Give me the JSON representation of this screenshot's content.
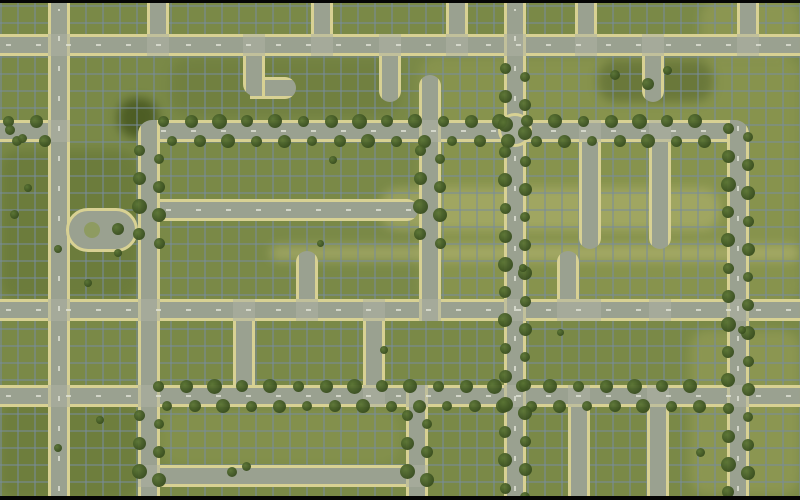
{
  "app": {
    "view": "city-builder-aerial-map",
    "visible_text": "none"
  },
  "scene": {
    "width": 800,
    "height": 500,
    "road_thickness": 22,
    "colors": {
      "grass": "#7a8947",
      "road_fill": "#9aa190",
      "road_edge": "#d8d193",
      "grid_line": "#788c9e",
      "tree_dark": "#394e1f",
      "tree_light": "#5a7434",
      "intersection": "#aeb3a3",
      "letterbox": "#050505",
      "lane_dash": "#e4e6da"
    },
    "letterbox": {
      "top": 3,
      "bottom": 4
    },
    "patches": [
      {
        "x": 420,
        "y": 56,
        "w": 380,
        "h": 250,
        "color": "#a3a85c",
        "op": 0.32
      },
      {
        "x": 380,
        "y": 188,
        "w": 340,
        "h": 42,
        "color": "#c9c583",
        "op": 0.38
      },
      {
        "x": 270,
        "y": 245,
        "w": 530,
        "h": 16,
        "color": "#c9c583",
        "op": 0.42
      },
      {
        "x": 118,
        "y": 98,
        "w": 40,
        "h": 40,
        "color": "#46561f",
        "op": 0.85
      },
      {
        "x": 0,
        "y": 150,
        "w": 140,
        "h": 150,
        "color": "#5d6e2f",
        "op": 0.45
      },
      {
        "x": 170,
        "y": 58,
        "w": 230,
        "h": 58,
        "color": "#687739",
        "op": 0.45
      },
      {
        "x": 598,
        "y": 60,
        "w": 115,
        "h": 42,
        "color": "#4e5e28",
        "op": 0.5
      },
      {
        "x": 690,
        "y": 330,
        "w": 110,
        "h": 165,
        "color": "#a8ab63",
        "op": 0.38
      },
      {
        "x": 700,
        "y": 0,
        "w": 100,
        "h": 56,
        "color": "#a8ab63",
        "op": 0.38
      },
      {
        "x": 0,
        "y": 400,
        "w": 140,
        "h": 100,
        "color": "#5d6e2f",
        "op": 0.4
      },
      {
        "x": 160,
        "y": 410,
        "w": 240,
        "h": 55,
        "color": "#97a057",
        "op": 0.32
      }
    ],
    "roads": [
      {
        "id": "top-avenue",
        "o": "h",
        "x": 0,
        "y": 34,
        "len": 800,
        "dashes": true
      },
      {
        "id": "tree-ave-west-stub",
        "o": "h",
        "x": 0,
        "y": 120,
        "len": 60,
        "trees": true
      },
      {
        "id": "tree-avenue",
        "o": "h",
        "x": 155,
        "y": 120,
        "len": 572,
        "trees": true,
        "dashes": true
      },
      {
        "id": "mid-deadend-road",
        "o": "h",
        "x": 160,
        "y": 199,
        "len": 258,
        "cap": "right",
        "dashes": true
      },
      {
        "id": "central-avenue",
        "o": "h",
        "x": 0,
        "y": 299,
        "len": 800,
        "dashes": true
      },
      {
        "id": "lower-tree-avenue",
        "o": "h",
        "x": 0,
        "y": 385,
        "len": 800,
        "dashes": true,
        "trees": true,
        "treeRange": [
          150,
          720
        ]
      },
      {
        "id": "bottom-street",
        "o": "h",
        "x": 155,
        "y": 465,
        "len": 273
      },
      {
        "id": "hook-stub-east",
        "o": "h",
        "x": 250,
        "y": 77,
        "len": 46,
        "cap": "right"
      },
      {
        "id": "west-vertical",
        "o": "v",
        "x": 48,
        "y": 3,
        "len": 494,
        "dashes": true
      },
      {
        "id": "v-top-a",
        "o": "v",
        "x": 147,
        "y": 3,
        "len": 31
      },
      {
        "id": "west-tree-vertical",
        "o": "v",
        "x": 138,
        "y": 120,
        "len": 377,
        "round": "14px 0 0 0",
        "trees": true,
        "treeRanges": [
          [
            142,
            258
          ],
          [
            407,
            494
          ]
        ]
      },
      {
        "id": "hook-vertical",
        "o": "v",
        "x": 243,
        "y": 56,
        "len": 40,
        "round": "0 0 0 12px"
      },
      {
        "id": "v-top-b",
        "o": "v",
        "x": 311,
        "y": 3,
        "len": 31
      },
      {
        "id": "v-top-c",
        "o": "v",
        "x": 446,
        "y": 3,
        "len": 31
      },
      {
        "id": "v-top-d",
        "o": "v",
        "x": 575,
        "y": 3,
        "len": 31
      },
      {
        "id": "v-top-e",
        "o": "v",
        "x": 737,
        "y": 3,
        "len": 31
      },
      {
        "id": "stub-from-top-a",
        "o": "v",
        "x": 379,
        "y": 56,
        "len": 46,
        "cap": "bottom"
      },
      {
        "id": "stub-from-top-b",
        "o": "v",
        "x": 642,
        "y": 56,
        "len": 46,
        "cap": "bottom"
      },
      {
        "id": "stub-up-center",
        "o": "v",
        "x": 419,
        "y": 75,
        "len": 45,
        "cap": "top"
      },
      {
        "id": "center-tree-vertical",
        "o": "v",
        "x": 419,
        "y": 120,
        "len": 201,
        "trees": true,
        "treeRanges": [
          [
            142,
            255
          ]
        ]
      },
      {
        "id": "main-tree-vertical",
        "o": "v",
        "x": 504,
        "y": 3,
        "len": 494,
        "trees": true,
        "treeRanges": [
          [
            60,
            494
          ]
        ],
        "dashes": true
      },
      {
        "id": "stub-down-mid-a",
        "o": "v",
        "x": 579,
        "y": 142,
        "len": 107,
        "cap": "bottom"
      },
      {
        "id": "stub-down-mid-b",
        "o": "v",
        "x": 649,
        "y": 142,
        "len": 107,
        "cap": "bottom"
      },
      {
        "id": "stub-up-central-a",
        "o": "v",
        "x": 296,
        "y": 251,
        "len": 48,
        "cap": "top"
      },
      {
        "id": "stub-up-central-b",
        "o": "v",
        "x": 557,
        "y": 251,
        "len": 48,
        "cap": "top"
      },
      {
        "id": "connector-a",
        "o": "v",
        "x": 233,
        "y": 321,
        "len": 64
      },
      {
        "id": "connector-b",
        "o": "v",
        "x": 363,
        "y": 321,
        "len": 64
      },
      {
        "id": "south-tree-vertical",
        "o": "v",
        "x": 406,
        "y": 385,
        "len": 112,
        "trees": true,
        "treeRanges": [
          [
            407,
            494
          ]
        ]
      },
      {
        "id": "south-street-a",
        "o": "v",
        "x": 568,
        "y": 407,
        "len": 90
      },
      {
        "id": "south-street-b",
        "o": "v",
        "x": 647,
        "y": 407,
        "len": 90
      },
      {
        "id": "east-tree-vertical",
        "o": "v",
        "x": 727,
        "y": 120,
        "len": 377,
        "round": "0 14px 0 0",
        "trees": true,
        "dashes": true
      }
    ],
    "cul_de_sac": {
      "x": 66,
      "y": 208,
      "w": 72,
      "h": 44,
      "tree": [
        118,
        229,
        12
      ]
    },
    "roundabout": {
      "x": 498,
      "y": 113,
      "w": 34,
      "h": 34
    },
    "intersections": [
      [
        48,
        34
      ],
      [
        147,
        34
      ],
      [
        243,
        34
      ],
      [
        311,
        34
      ],
      [
        379,
        34
      ],
      [
        446,
        34
      ],
      [
        504,
        34
      ],
      [
        575,
        34
      ],
      [
        642,
        34
      ],
      [
        737,
        34
      ],
      [
        48,
        120
      ],
      [
        419,
        120
      ],
      [
        579,
        120
      ],
      [
        649,
        120
      ],
      [
        48,
        299
      ],
      [
        138,
        299
      ],
      [
        233,
        299
      ],
      [
        296,
        299
      ],
      [
        363,
        299
      ],
      [
        419,
        299
      ],
      [
        504,
        299
      ],
      [
        557,
        299
      ],
      [
        579,
        299
      ],
      [
        649,
        299
      ],
      [
        727,
        299
      ],
      [
        48,
        385
      ],
      [
        138,
        385
      ],
      [
        363,
        385
      ],
      [
        406,
        385
      ],
      [
        504,
        385
      ],
      [
        568,
        385
      ],
      [
        647,
        385
      ],
      [
        727,
        385
      ],
      [
        138,
        465
      ],
      [
        406,
        465
      ]
    ],
    "scatter_trees": [
      [
        14,
        214,
        9
      ],
      [
        58,
        249,
        8
      ],
      [
        88,
        283,
        8
      ],
      [
        118,
        253,
        8
      ],
      [
        28,
        188,
        8
      ],
      [
        320,
        243,
        7
      ],
      [
        333,
        160,
        8
      ],
      [
        523,
        268,
        8
      ],
      [
        615,
        75,
        10
      ],
      [
        648,
        84,
        12
      ],
      [
        667,
        70,
        9
      ],
      [
        700,
        452,
        9
      ],
      [
        232,
        472,
        10
      ],
      [
        246,
        466,
        9
      ],
      [
        384,
        350,
        8
      ],
      [
        742,
        330,
        8
      ],
      [
        58,
        448,
        8
      ],
      [
        100,
        420,
        8
      ],
      [
        560,
        332,
        7
      ],
      [
        10,
        130,
        10
      ],
      [
        22,
        138,
        9
      ]
    ],
    "tree_spacing": 28
  }
}
